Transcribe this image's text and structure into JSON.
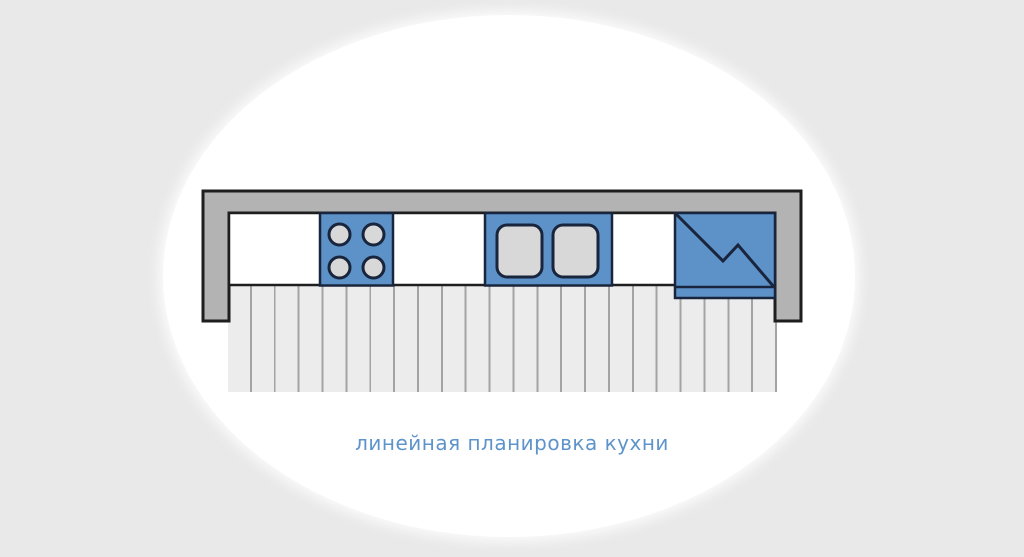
{
  "caption": {
    "text": "линейная планировка кухни"
  },
  "colors": {
    "page_background": "#e9e9e9",
    "canvas": "#ffffff",
    "wall": "#b3b3b3",
    "wall_outline": "#1e1e1e",
    "appliance": "#5d92c8",
    "appliance_outline": "#19253c",
    "fixture": "#d8d8d8",
    "counter": "#ffffff",
    "floor": "#ececec",
    "floor_line": "#a3a3a3",
    "caption": "#5e94ca"
  },
  "diagram": {
    "type": "kitchen-floor-plan",
    "elements": [
      "wall",
      "countertop",
      "stove-4-burners",
      "double-sink",
      "refrigerator",
      "plank-floor"
    ]
  }
}
